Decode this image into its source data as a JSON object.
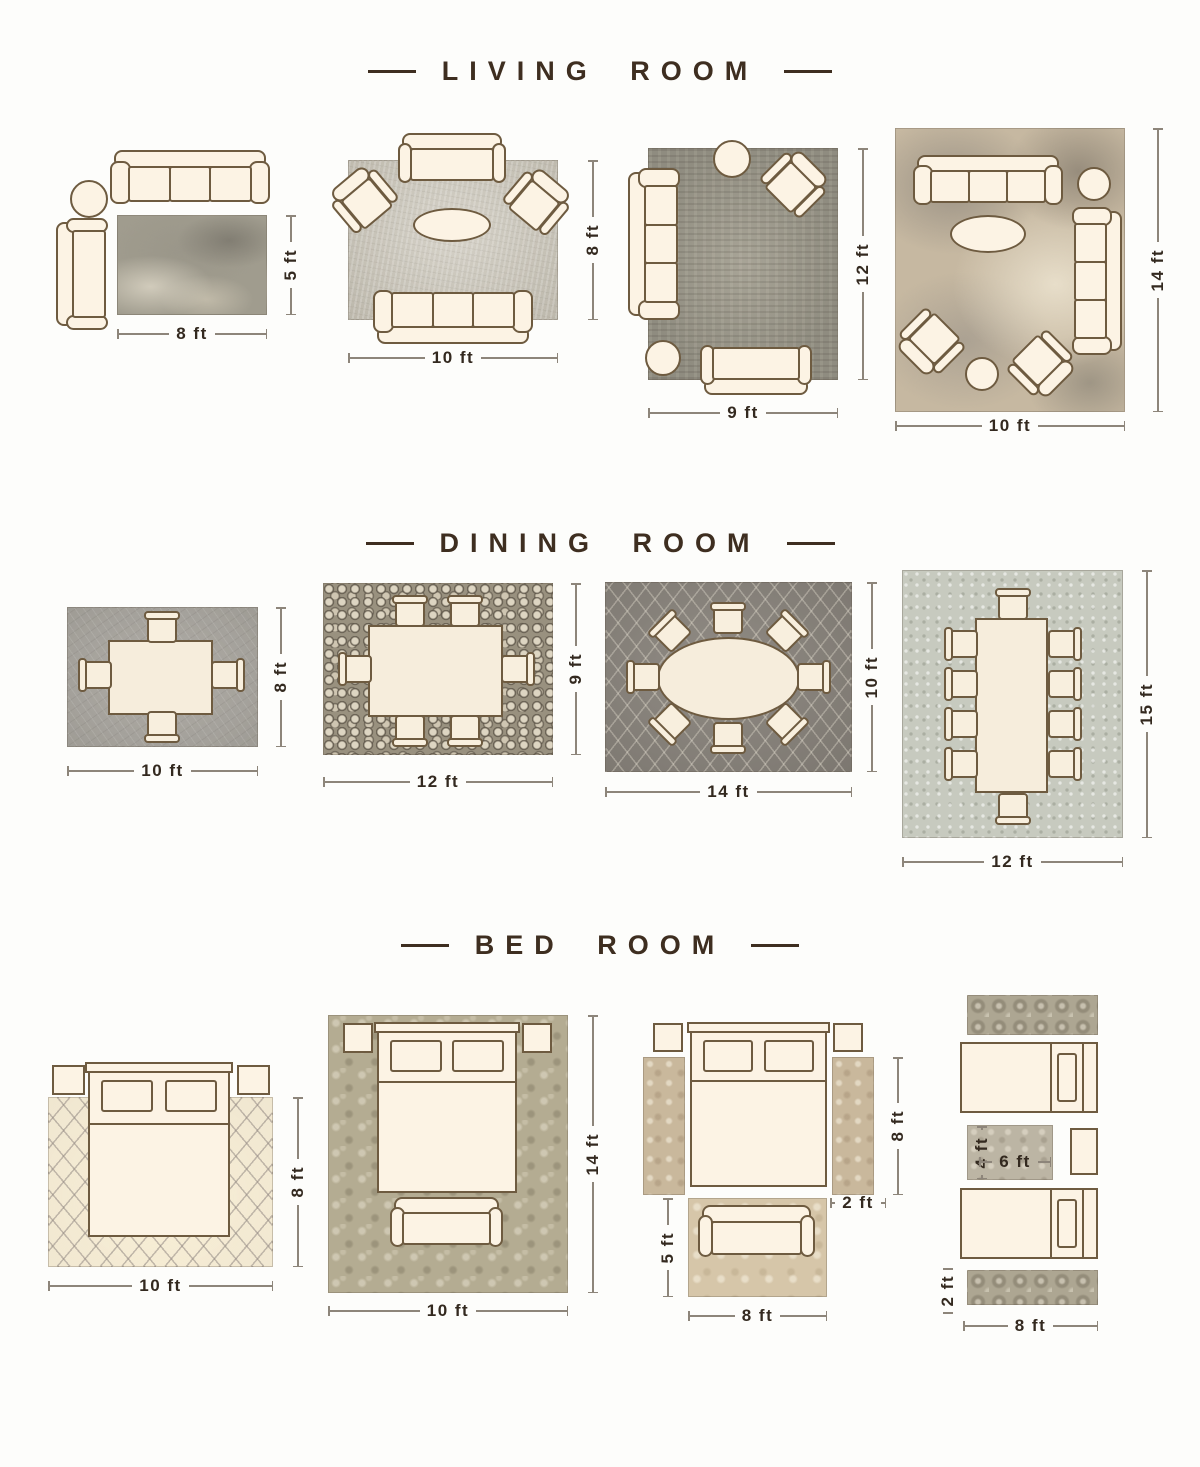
{
  "colors": {
    "accent_brown": "#3e2e20",
    "dimension_text": "#33291f",
    "dimension_line": "#8d857a",
    "furniture_outline": "#6e5b40",
    "furniture_fill": "#fcf3e4"
  },
  "sections": [
    {
      "title": "LIVING ROOM",
      "layouts": [
        {
          "name": "sofa-side-chair-rug",
          "width": "8 ft",
          "height": "5 ft"
        },
        {
          "name": "symmetric-seating-rug",
          "width": "10 ft",
          "height": "8 ft"
        },
        {
          "name": "corner-seating-rug",
          "width": "9 ft",
          "height": "12 ft"
        },
        {
          "name": "full-room-seating-rug",
          "width": "10 ft",
          "height": "14 ft"
        }
      ]
    },
    {
      "title": "DINING ROOM",
      "layouts": [
        {
          "name": "table-4-chairs-rug",
          "width": "10 ft",
          "height": "8 ft"
        },
        {
          "name": "table-6-chairs-rug",
          "width": "12 ft",
          "height": "9 ft"
        },
        {
          "name": "oval-table-8-chairs-rug",
          "width": "14 ft",
          "height": "10 ft"
        },
        {
          "name": "long-table-10-chairs-rug",
          "width": "12 ft",
          "height": "15 ft"
        }
      ]
    },
    {
      "title": "BED ROOM",
      "layouts": [
        {
          "name": "bed-partial-rug",
          "width": "10 ft",
          "height": "8 ft"
        },
        {
          "name": "bed-full-rug",
          "width": "10 ft",
          "height": "14 ft"
        },
        {
          "name": "bed-side-runners",
          "runner_length": "8 ft",
          "runner_width": "2 ft",
          "foot_rug_height": "5 ft",
          "foot_rug_width": "8 ft"
        },
        {
          "name": "twin-beds-runners",
          "mid_rug_height": "4 ft",
          "mid_rug_width": "6 ft",
          "runner_width": "2 ft",
          "runner_length": "8 ft"
        }
      ]
    }
  ]
}
